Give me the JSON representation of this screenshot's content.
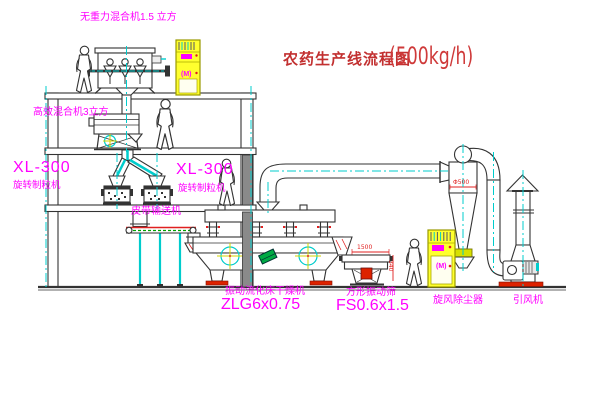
{
  "title": {
    "text": "农药生产线流程图",
    "capacity": "(500kg/h)"
  },
  "equipment": {
    "top_mixer": {
      "label": "无重力混合机1.5 立方"
    },
    "mid_mixer": {
      "label": "高效混合机3立方"
    },
    "granulator_left": {
      "model": "XL-300",
      "label": "旋转制粒机"
    },
    "granulator_right": {
      "model": "XL-300",
      "label": "旋转制粒机"
    },
    "belt_conveyor": {
      "label": "皮带输送机"
    },
    "dryer": {
      "label": "振动流化床干燥机",
      "model": "ZLG6x0.75"
    },
    "sieve": {
      "label": "方形振动筛",
      "model": "FS0.6x1.5"
    },
    "cyclone": {
      "label": "旋风除尘器"
    },
    "induced_fan": {
      "label": "引风机"
    },
    "control_cabinet_1": {
      "motor_mark": "(M)"
    },
    "control_cabinet_2": {
      "motor_mark": "(M)"
    }
  },
  "dimensions": {
    "cyclone_diameter": "Φ500",
    "sieve_length": "1500",
    "sieve_height": "340"
  },
  "colors": {
    "label_magenta": "#ff00ff",
    "title_red": "#c23030",
    "line_dark": "#333333",
    "centerline_cyan": "#00cccc",
    "cabinet_yellow": "#ffff2e",
    "accent_red": "#e02020",
    "conveyor_green": "#00a000"
  }
}
